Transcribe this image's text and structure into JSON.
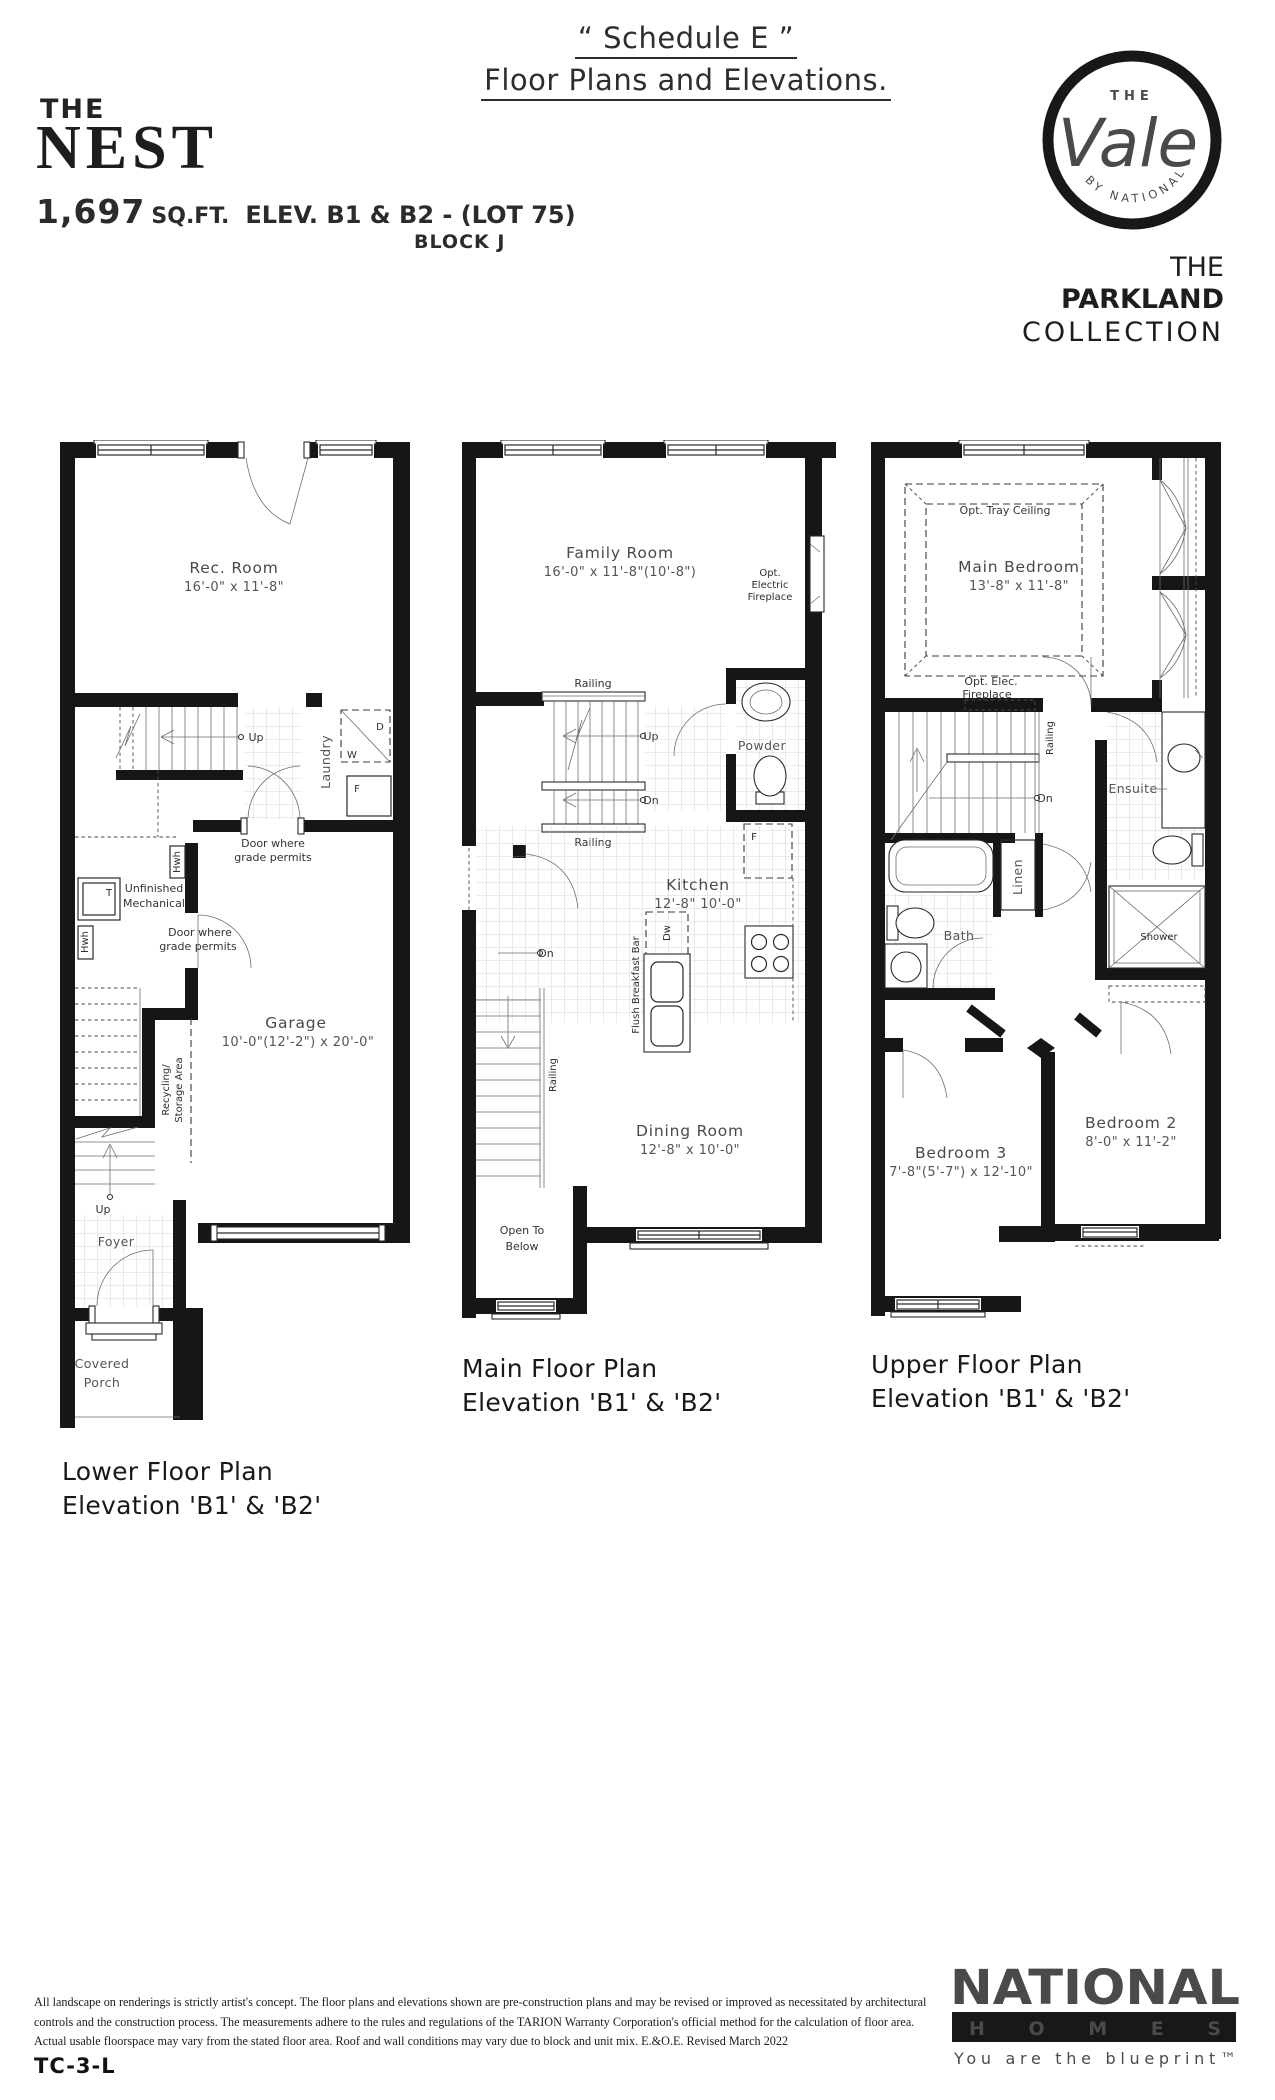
{
  "header": {
    "schedule_line1": "“ Schedule E ”",
    "schedule_line2": "Floor Plans and Elevations.",
    "the": "THE",
    "name": "NEST",
    "sqft_value": "1,697",
    "sqft_unit": "SQ.FT.",
    "elev": "ELEV. B1 & B2 - (LOT 75)",
    "block": "BLOCK J"
  },
  "brand": {
    "logo_the": "THE",
    "logo_vale": "Vale",
    "logo_by": "BY NATIONAL",
    "collection_the": "THE ",
    "collection_name": "PARKLAND",
    "collection_line2": "COLLECTION"
  },
  "plans": {
    "lower": {
      "caption": [
        "Lower Floor Plan",
        "Elevation 'B1' & 'B2'"
      ],
      "labels": {
        "rec_room": "Rec. Room",
        "rec_room_dims": "16'-0\" x 11'-8\"",
        "up_stairs": "Up",
        "laundry": "Laundry",
        "dryer": "D",
        "washer": "W",
        "freezer": "F",
        "door_grade_1": [
          "Door where",
          "grade permits"
        ],
        "hwh_1": "Hwh",
        "tank": "T",
        "unfinished": [
          "Unfinished",
          "Mechanical"
        ],
        "hwh_2": "Hwh",
        "door_grade_2": [
          "Door where",
          "grade permits"
        ],
        "garage": "Garage",
        "garage_dims": "10'-0\"(12'-2\") x 20'-0\"",
        "recycling": [
          "Recycling/",
          "Storage Area"
        ],
        "up_foyer": "Up",
        "foyer": "Foyer",
        "covered_porch": [
          "Covered",
          "Porch"
        ]
      }
    },
    "main": {
      "caption": [
        "Main Floor Plan",
        "Elevation 'B1' & 'B2'"
      ],
      "labels": {
        "family_room": "Family Room",
        "family_room_dims": "16'-0\" x 11'-8\"(10'-8\")",
        "opt_fireplace": [
          "Opt.",
          "Electric",
          "Fireplace"
        ],
        "railing_top": "Railing",
        "up": "Up",
        "dn_stairs": "Dn",
        "railing_bottom": "Railing",
        "powder": "Powder",
        "kitchen": "Kitchen",
        "kitchen_dims": "12'-8\"  10'-0\"",
        "fridge": "F",
        "dishwasher": "Dw",
        "breakfast_bar": "Flush Breakfast Bar",
        "dn_side": "Dn",
        "railing_side": "Railing",
        "dining_room": "Dining Room",
        "dining_room_dims": "12'-8\" x 10'-0\"",
        "open_to_below": [
          "Open To",
          "Below"
        ]
      }
    },
    "upper": {
      "caption": [
        "Upper Floor Plan",
        "Elevation 'B1' & 'B2'"
      ],
      "labels": {
        "tray_ceiling": "Opt. Tray Ceiling",
        "main_bedroom": "Main Bedroom",
        "main_bedroom_dims": "13'-8\" x 11'-8\"",
        "opt_elec_fireplace": [
          "Opt. Elec.",
          "Fireplace"
        ],
        "railing": "Railing",
        "dn": "Dn",
        "ensuite": "Ensuite",
        "linen": "Linen",
        "bath": "Bath",
        "shower": "Shower",
        "bedroom2": "Bedroom 2",
        "bedroom2_dims": "8'-0\" x 11'-2\"",
        "bedroom3": "Bedroom 3",
        "bedroom3_dims": "7'-8\"(5'-7\") x 12'-10\""
      }
    }
  },
  "footer": {
    "disclaimer": [
      "All landscape on renderings is strictly artist's concept. The floor plans and elevations shown are pre-construction plans and may be revised or improved as necessitated by architectural",
      "controls and the construction process.  The measurements adhere to the rules and regulations of the TARION Warranty Corporation's official method for the calculation of floor area.",
      "Actual usable floorspace may vary from the stated floor area. Roof and wall conditions may vary due to block and unit mix.  E.&O.E. Revised March 2022"
    ],
    "plan_code": "TC-3-L",
    "national": "NATIONAL",
    "homes": "HOMES",
    "tagline": "You are the blueprint™"
  }
}
